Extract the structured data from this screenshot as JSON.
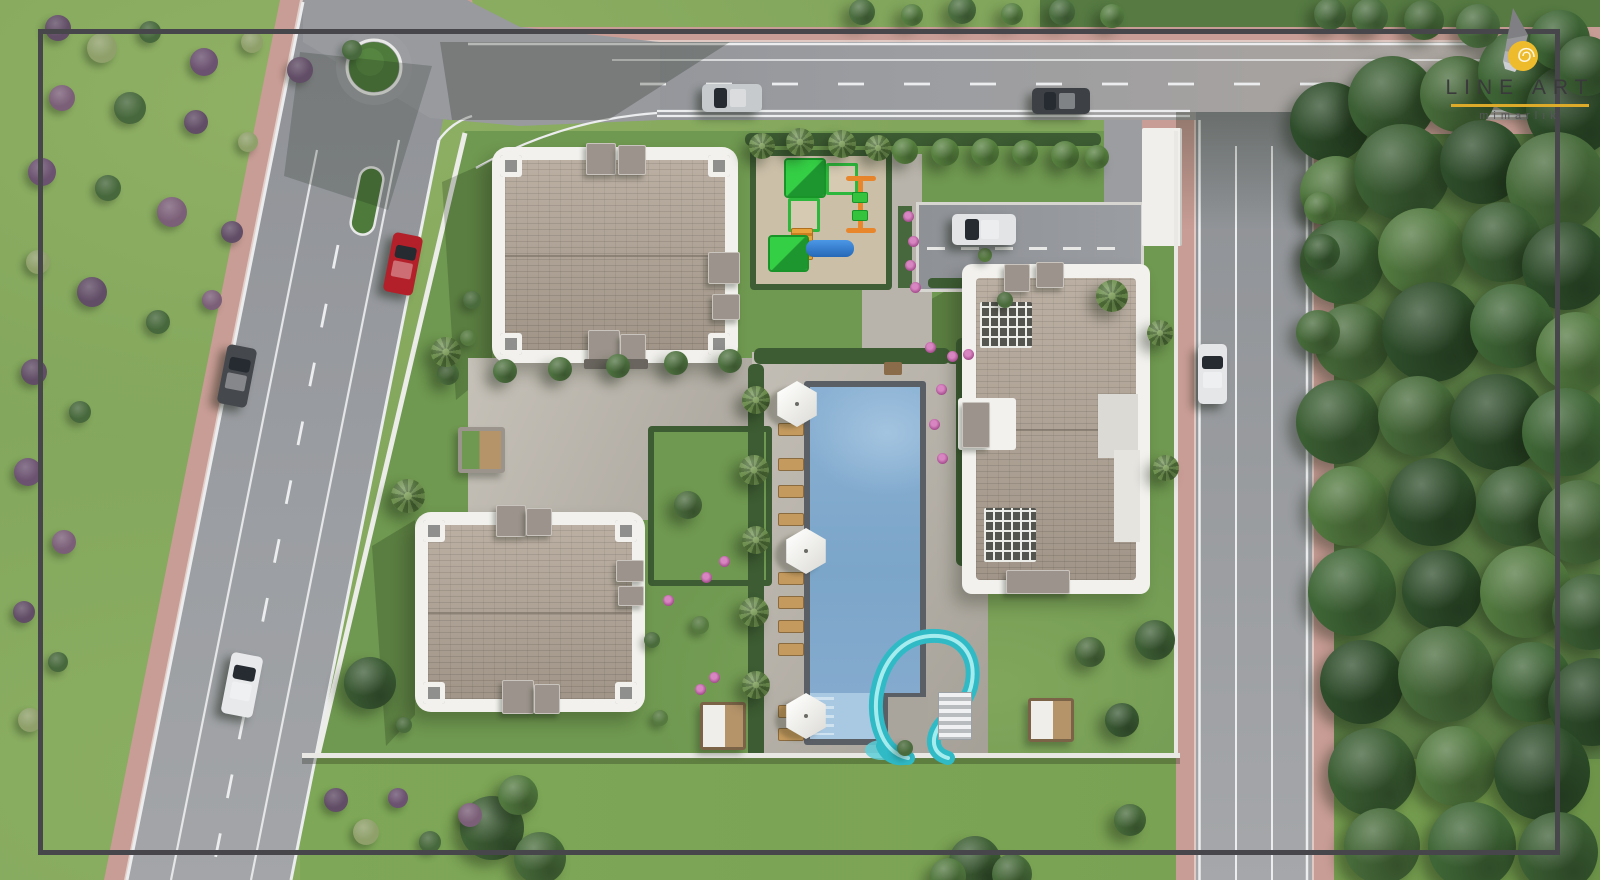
{
  "brand": {
    "title": "LINE ART",
    "subtitle": "mimarlık"
  },
  "palette": {
    "frame": "#46464b",
    "grass_base": "#82a65c",
    "grass_site": "#6f9850",
    "grass_right": "#5a7c44",
    "asphalt": "#97999d",
    "sidewalk": "#c89d95",
    "pavement": "#b6b1a9",
    "roof_tan": "#b3a698",
    "building_white": "#f2f1ed",
    "pool_water": "#87afd0",
    "pool_kids": "#a9c8e2",
    "slide_teal": "#2fbac6",
    "hedge": "#3d5c33",
    "sand": "#cbbfa8",
    "play_green": "#2db83d",
    "play_orange": "#e8862c",
    "play_blue": "#2f80d8",
    "umbrella": "#f4f3f0",
    "wood": "#c49a5e",
    "flower": "#a64d8e",
    "gold": "#ddab29",
    "logo_text": "#3a3a3c",
    "logo_sub": "#56565a"
  },
  "objects": {
    "cars": [
      {
        "name": "red-car",
        "x": 388,
        "y": 234,
        "w": 30,
        "h": 60,
        "rot": 11,
        "color": "#b3202a"
      },
      {
        "name": "gray-car-boulevard",
        "x": 222,
        "y": 346,
        "w": 30,
        "h": 60,
        "rot": 11,
        "color": "#45484d"
      },
      {
        "name": "white-car-boulevard",
        "x": 226,
        "y": 654,
        "w": 32,
        "h": 62,
        "rot": 11,
        "color": "#e7e9eb"
      },
      {
        "name": "silver-car-top-road",
        "x": 702,
        "y": 84,
        "w": 60,
        "h": 28,
        "rot": 0,
        "color": "#c6cacd"
      },
      {
        "name": "dark-car-top-road",
        "x": 1032,
        "y": 88,
        "w": 58,
        "h": 26,
        "rot": 0,
        "color": "#3d4145"
      },
      {
        "name": "white-car-driveway",
        "x": 952,
        "y": 214,
        "w": 64,
        "h": 31,
        "rot": 0,
        "color": "#e2e4e6"
      },
      {
        "name": "white-car-right-road",
        "x": 1198,
        "y": 344,
        "w": 29,
        "h": 60,
        "rot": 0,
        "color": "#e4e6e8"
      }
    ],
    "trees": [
      [
        1330,
        122,
        40,
        "#2e4d2a"
      ],
      [
        1392,
        100,
        44,
        "#3b5e33"
      ],
      [
        1458,
        94,
        38,
        "#476b3a"
      ],
      [
        1520,
        72,
        42,
        "#3f6636"
      ],
      [
        1572,
        110,
        46,
        "#2e4d2a"
      ],
      [
        1336,
        192,
        36,
        "#52793f"
      ],
      [
        1402,
        172,
        48,
        "#3b5e33"
      ],
      [
        1482,
        162,
        42,
        "#2e4d2a"
      ],
      [
        1556,
        182,
        50,
        "#476b3a"
      ],
      [
        1342,
        262,
        42,
        "#3f6636"
      ],
      [
        1422,
        252,
        44,
        "#52793f"
      ],
      [
        1502,
        242,
        40,
        "#3b5e33"
      ],
      [
        1566,
        266,
        44,
        "#2e4d2a"
      ],
      [
        1352,
        342,
        38,
        "#476b3a"
      ],
      [
        1432,
        332,
        50,
        "#2e4d2a"
      ],
      [
        1512,
        326,
        42,
        "#3f6636"
      ],
      [
        1576,
        352,
        40,
        "#52793f"
      ],
      [
        1338,
        422,
        42,
        "#3b5e33"
      ],
      [
        1418,
        416,
        40,
        "#476b3a"
      ],
      [
        1498,
        422,
        48,
        "#2e4d2a"
      ],
      [
        1566,
        432,
        44,
        "#3f6636"
      ],
      [
        1348,
        506,
        40,
        "#52793f"
      ],
      [
        1432,
        502,
        44,
        "#2e4d2a"
      ],
      [
        1516,
        506,
        40,
        "#3b5e33"
      ],
      [
        1580,
        522,
        42,
        "#476b3a"
      ],
      [
        1352,
        592,
        44,
        "#3f6636"
      ],
      [
        1442,
        590,
        40,
        "#2e4d2a"
      ],
      [
        1526,
        592,
        46,
        "#52793f"
      ],
      [
        1590,
        612,
        38,
        "#3b5e33"
      ],
      [
        1362,
        682,
        42,
        "#2e4d2a"
      ],
      [
        1446,
        674,
        48,
        "#476b3a"
      ],
      [
        1532,
        682,
        40,
        "#3f6636"
      ],
      [
        1592,
        702,
        44,
        "#2e4d2a"
      ],
      [
        1372,
        772,
        44,
        "#3b5e33"
      ],
      [
        1456,
        766,
        40,
        "#52793f"
      ],
      [
        1542,
        772,
        48,
        "#2e4d2a"
      ],
      [
        1382,
        846,
        38,
        "#476b3a"
      ],
      [
        1472,
        846,
        44,
        "#3f6636"
      ],
      [
        1558,
        852,
        40,
        "#3b5e33"
      ],
      [
        1318,
        332,
        22,
        "#476b3a"
      ],
      [
        1322,
        252,
        18,
        "#3b5e33"
      ],
      [
        1320,
        208,
        16,
        "#52793f"
      ],
      [
        1330,
        14,
        16,
        "#4c7040"
      ],
      [
        1370,
        16,
        18,
        "#4c7040"
      ],
      [
        1424,
        20,
        20,
        "#476b3a"
      ],
      [
        1478,
        26,
        22,
        "#4c7040"
      ],
      [
        1560,
        40,
        30,
        "#3f6636"
      ],
      [
        1586,
        66,
        30,
        "#3b5e33"
      ],
      [
        862,
        12,
        13,
        "#4c7040"
      ],
      [
        912,
        15,
        11,
        "#577f42"
      ],
      [
        962,
        10,
        14,
        "#4c7040"
      ],
      [
        1012,
        14,
        11,
        "#577f42"
      ],
      [
        1062,
        12,
        13,
        "#4c7040"
      ],
      [
        1112,
        16,
        12,
        "#577f42"
      ],
      [
        448,
        374,
        11,
        "#4f7340"
      ],
      [
        505,
        371,
        12,
        "#4f7340"
      ],
      [
        560,
        369,
        12,
        "#4f7340"
      ],
      [
        618,
        366,
        12,
        "#4f7340"
      ],
      [
        676,
        363,
        12,
        "#4f7340"
      ],
      [
        730,
        361,
        12,
        "#4f7340"
      ],
      [
        905,
        151,
        13,
        "#57813f"
      ],
      [
        945,
        152,
        14,
        "#57813f"
      ],
      [
        985,
        152,
        14,
        "#57813f"
      ],
      [
        1025,
        153,
        13,
        "#57813f"
      ],
      [
        1065,
        155,
        14,
        "#57813f"
      ],
      [
        1097,
        157,
        12,
        "#57813f"
      ],
      [
        762,
        146,
        13,
        "palm"
      ],
      [
        800,
        142,
        14,
        "palm"
      ],
      [
        842,
        144,
        14,
        "palm"
      ],
      [
        878,
        148,
        13,
        "palm"
      ],
      [
        756,
        400,
        14,
        "palm"
      ],
      [
        754,
        470,
        15,
        "palm"
      ],
      [
        756,
        540,
        14,
        "palm"
      ],
      [
        754,
        612,
        15,
        "palm"
      ],
      [
        756,
        685,
        14,
        "palm"
      ],
      [
        446,
        352,
        15,
        "palm"
      ],
      [
        408,
        496,
        17,
        "palm"
      ],
      [
        1112,
        296,
        16,
        "palm"
      ],
      [
        1160,
        333,
        13,
        "palm"
      ],
      [
        1166,
        468,
        13,
        "palm"
      ],
      [
        370,
        683,
        26,
        "#3a5a33"
      ],
      [
        688,
        505,
        14,
        "#4a6b3c"
      ],
      [
        1090,
        652,
        15,
        "#4a6b3c"
      ],
      [
        1155,
        640,
        20,
        "#3f6136"
      ],
      [
        1122,
        720,
        17,
        "#3a5a33"
      ],
      [
        492,
        828,
        32,
        "#3f6136"
      ],
      [
        540,
        858,
        26,
        "#476b3a"
      ],
      [
        518,
        795,
        20,
        "#52793f"
      ],
      [
        975,
        862,
        26,
        "#3f6136"
      ],
      [
        1012,
        874,
        20,
        "#476b3a"
      ],
      [
        948,
        876,
        18,
        "#52793f"
      ],
      [
        1130,
        820,
        16,
        "#476b3a"
      ]
    ],
    "bushes": [
      [
        58,
        28,
        13,
        "#614d66"
      ],
      [
        102,
        48,
        15,
        "#8fa06a"
      ],
      [
        150,
        32,
        11,
        "#47683c"
      ],
      [
        204,
        62,
        14,
        "#6b5270"
      ],
      [
        252,
        42,
        11,
        "#8fa06a"
      ],
      [
        300,
        70,
        13,
        "#614d66"
      ],
      [
        352,
        50,
        10,
        "#47683c"
      ],
      [
        62,
        98,
        13,
        "#7b5f78"
      ],
      [
        130,
        108,
        16,
        "#47683c"
      ],
      [
        196,
        122,
        12,
        "#614d66"
      ],
      [
        248,
        142,
        10,
        "#8fa06a"
      ],
      [
        42,
        172,
        14,
        "#6b5270"
      ],
      [
        108,
        188,
        13,
        "#47683c"
      ],
      [
        172,
        212,
        15,
        "#7b5f78"
      ],
      [
        232,
        232,
        11,
        "#614d66"
      ],
      [
        38,
        262,
        12,
        "#8fa06a"
      ],
      [
        92,
        292,
        15,
        "#614d66"
      ],
      [
        158,
        322,
        12,
        "#47683c"
      ],
      [
        212,
        300,
        10,
        "#7b5f78"
      ],
      [
        34,
        372,
        13,
        "#614d66"
      ],
      [
        80,
        412,
        11,
        "#47683c"
      ],
      [
        28,
        472,
        14,
        "#6b5270"
      ],
      [
        64,
        542,
        12,
        "#7b5f78"
      ],
      [
        24,
        612,
        11,
        "#614d66"
      ],
      [
        58,
        662,
        10,
        "#47683c"
      ],
      [
        30,
        720,
        12,
        "#8fa06a"
      ],
      [
        336,
        800,
        12,
        "#614d66"
      ],
      [
        366,
        832,
        13,
        "#8fa06a"
      ],
      [
        398,
        798,
        10,
        "#6b5270"
      ],
      [
        430,
        842,
        11,
        "#47683c"
      ],
      [
        470,
        815,
        12,
        "#7b5f78"
      ],
      [
        472,
        300,
        9,
        "#4a6b3c"
      ],
      [
        468,
        338,
        8,
        "#55793f"
      ],
      [
        652,
        640,
        8,
        "#4a6b3c"
      ],
      [
        700,
        625,
        9,
        "#55793f"
      ],
      [
        404,
        725,
        8,
        "#4a6b3c"
      ],
      [
        660,
        718,
        8,
        "#55793f"
      ],
      [
        905,
        748,
        8,
        "#4a6b3c"
      ],
      [
        1005,
        300,
        8,
        "#4a6b3c"
      ],
      [
        985,
        255,
        7,
        "#55793f"
      ]
    ],
    "flowers": [
      [
        908,
        216
      ],
      [
        913,
        241
      ],
      [
        910,
        265
      ],
      [
        915,
        287
      ],
      [
        930,
        347
      ],
      [
        941,
        389
      ],
      [
        934,
        424
      ],
      [
        942,
        458
      ],
      [
        706,
        577
      ],
      [
        724,
        561
      ],
      [
        700,
        689
      ],
      [
        714,
        677
      ],
      [
        668,
        600
      ],
      [
        952,
        356
      ],
      [
        968,
        354
      ]
    ],
    "loungers": {
      "x": 778,
      "w": 24,
      "h": 11,
      "ys": [
        423,
        458,
        485,
        513,
        572,
        596,
        620,
        643,
        705,
        728
      ]
    },
    "umbrellas": [
      [
        797,
        404
      ],
      [
        806,
        551
      ],
      [
        806,
        716
      ]
    ]
  }
}
